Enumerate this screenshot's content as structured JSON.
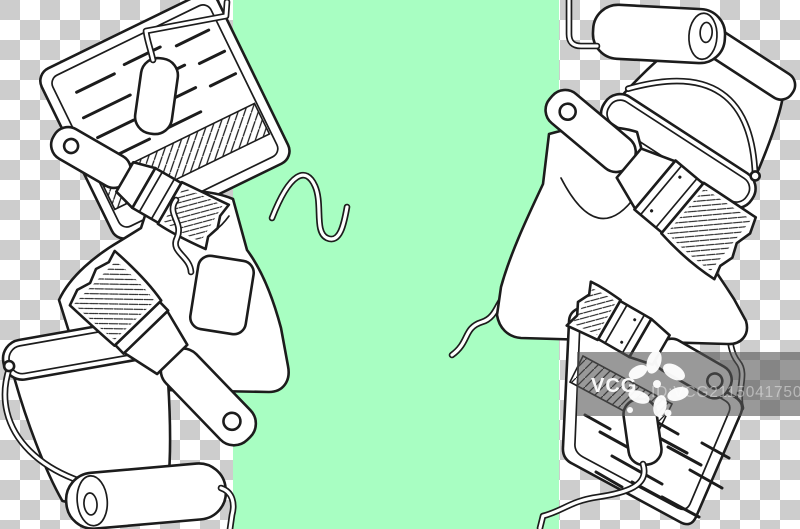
{
  "image": {
    "kind": "stock illustration preview",
    "subject": "black-and-white outline sketch of painting tools (paint rollers, flat brushes, buckets, roller trays, work aprons) grouped at left and right over a transparency checkerboard, with a vertical mint-green stripe through the middle"
  },
  "background": {
    "checker_light": "#ffffff",
    "checker_dark": "#cdcdcd",
    "checker_cell_px": 20,
    "green_stripe_color": "#a8fec2",
    "green_stripe_x": 233,
    "green_stripe_width": 326
  },
  "illustration": {
    "stroke_color": "#1c1c1c",
    "fill_color": "#ffffff",
    "left_objects": [
      {
        "icon": "paint-tray-with-roller-icon",
        "position": "top-left"
      },
      {
        "icon": "flat-brush-dripping-icon",
        "position": "upper-left"
      },
      {
        "icon": "apron-with-pocket-icon",
        "position": "middle-left"
      },
      {
        "icon": "wide-flat-brush-icon",
        "position": "lower-left"
      },
      {
        "icon": "paint-bucket-icon",
        "position": "bottom-left"
      },
      {
        "icon": "roller-sleeve-icon",
        "position": "bottom-left-corner"
      }
    ],
    "right_objects": [
      {
        "icon": "paint-roller-icon",
        "position": "top-right"
      },
      {
        "icon": "tilted-paint-bucket-icon",
        "position": "top-right-corner"
      },
      {
        "icon": "wide-flat-brush-icon",
        "position": "right"
      },
      {
        "icon": "apron-with-ties-icon",
        "position": "middle-right"
      },
      {
        "icon": "flat-brush-icon",
        "position": "lower-right"
      },
      {
        "icon": "paint-tray-with-roller-icon",
        "position": "bottom-right"
      }
    ]
  },
  "watermark": {
    "brand": "VCG",
    "id_label": "ID:VCG211504175034",
    "box_color": "#555555",
    "box_opacity": "0.6",
    "brand_text_color": "#ffffff",
    "id_text_color": "#c6c6c6"
  }
}
